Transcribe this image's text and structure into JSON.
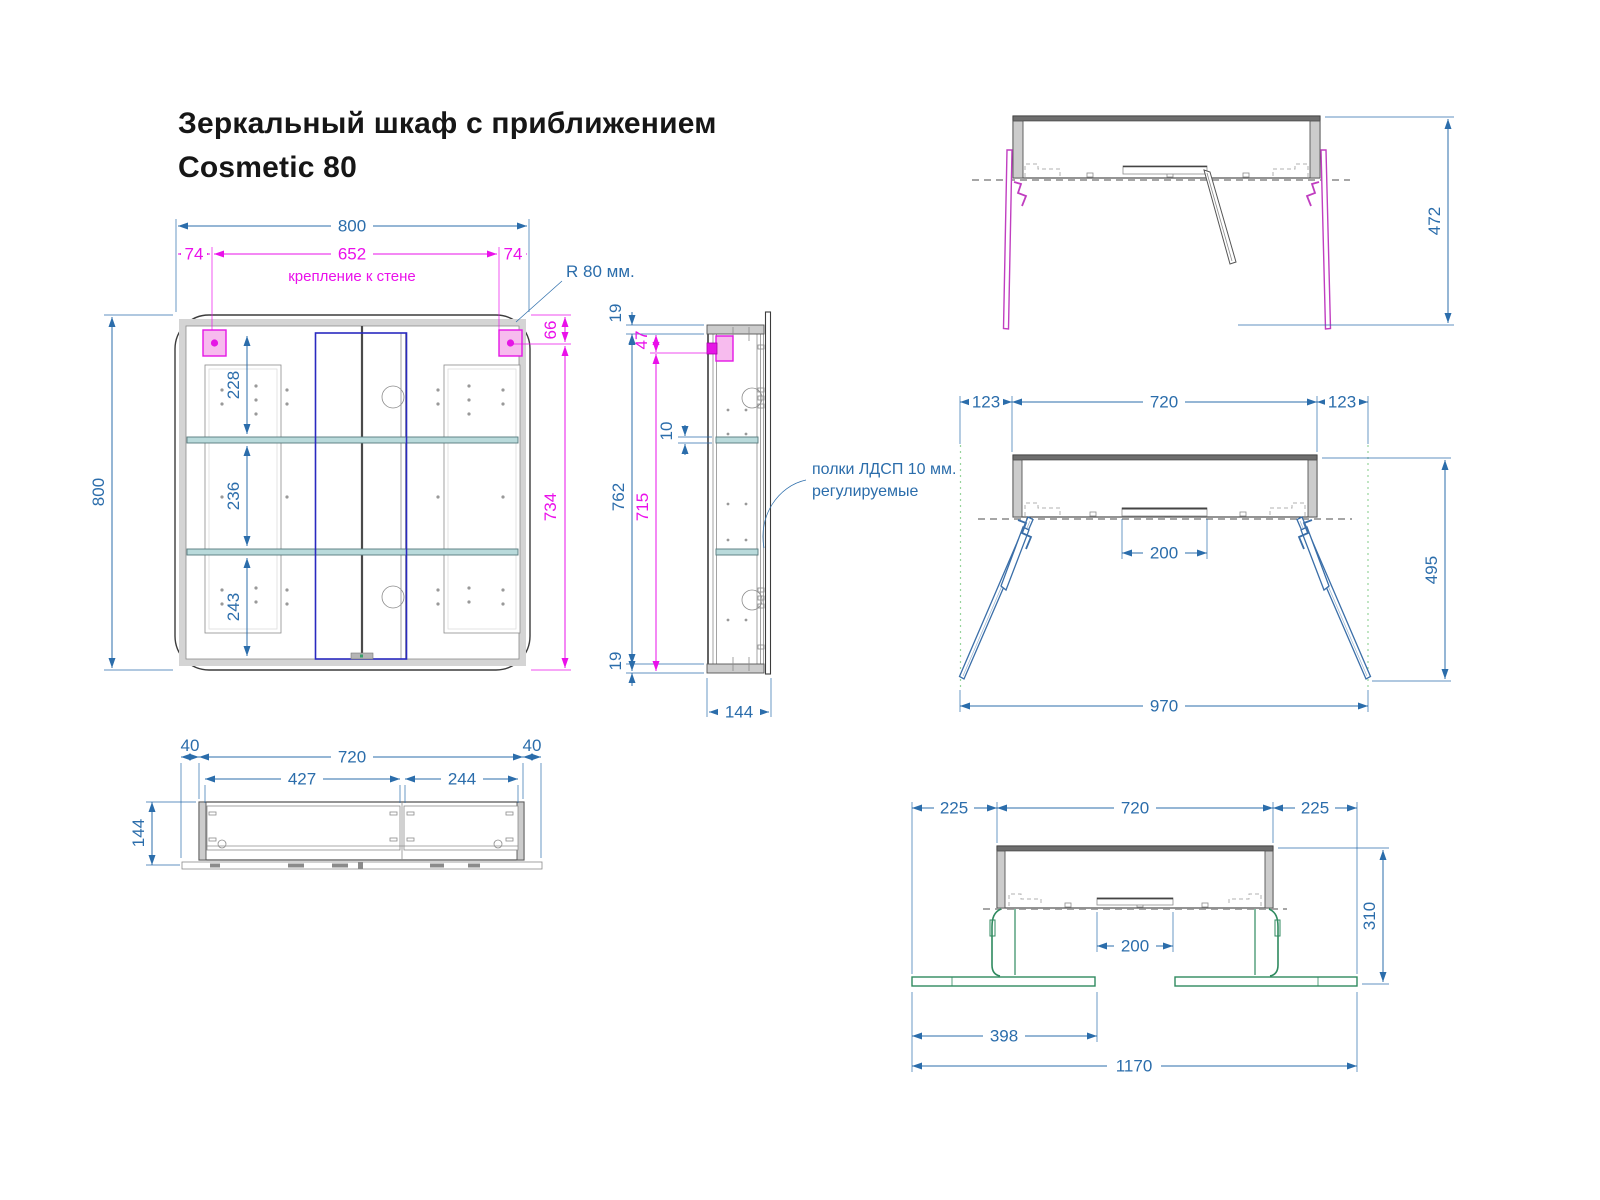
{
  "title": {
    "line1": "Зеркальный шкаф с приближением",
    "line2": "Cosmetic 80"
  },
  "colors": {
    "dimension_blue": "#2b6dab",
    "dimension_magenta": "#ea10ea",
    "bracket_pink_fill": "#f7bbee",
    "bracket_magenta": "#e516e5",
    "shelf_teal": "#b9dadb",
    "frame_gray": "#cccccc",
    "mirror_door_blue": "#2a2ac0",
    "open_door_magenta": "#c03ec0",
    "open_door_blue": "#3a6ea8",
    "open_door_green": "#2f8a5f",
    "guide_green": "#97d49b"
  },
  "front_view": {
    "dims": {
      "total_width": "800",
      "total_height": "800",
      "mount_offset_left": "74",
      "mount_span": "652",
      "mount_offset_right": "74",
      "mount_note": "крепление к стене",
      "corner_radius": "R 80 мм.",
      "top_to_mount": "66",
      "mount_to_bottom": "734",
      "section_top": "228",
      "section_middle": "236",
      "section_bottom": "243"
    }
  },
  "side_view": {
    "dims": {
      "top_panel": "19",
      "inner_height": "762",
      "top_to_mount": "47",
      "shelf_thickness": "10",
      "mount_to_bottom": "715",
      "bottom_panel": "19",
      "depth": "144"
    },
    "note": {
      "line1": "полки ЛДСП 10 мм.",
      "line2": "регулируемые"
    }
  },
  "top_view_closed": {
    "dims": {
      "side_left": "40",
      "body_width": "720",
      "side_right": "40",
      "door_left": "427",
      "door_right": "244",
      "depth": "144"
    }
  },
  "top_view_doors_90": {
    "dims": {
      "depth_open": "472"
    }
  },
  "top_view_doors_45": {
    "dims": {
      "door_left": "123",
      "body_width": "720",
      "door_right": "123",
      "mirror_width": "200",
      "depth_open": "495",
      "total_width": "970"
    }
  },
  "top_view_doors_flat": {
    "dims": {
      "door_left": "225",
      "body_width": "720",
      "door_right": "225",
      "mirror_width": "200",
      "depth_open": "310",
      "door_panel": "398",
      "total_width": "1170"
    }
  }
}
